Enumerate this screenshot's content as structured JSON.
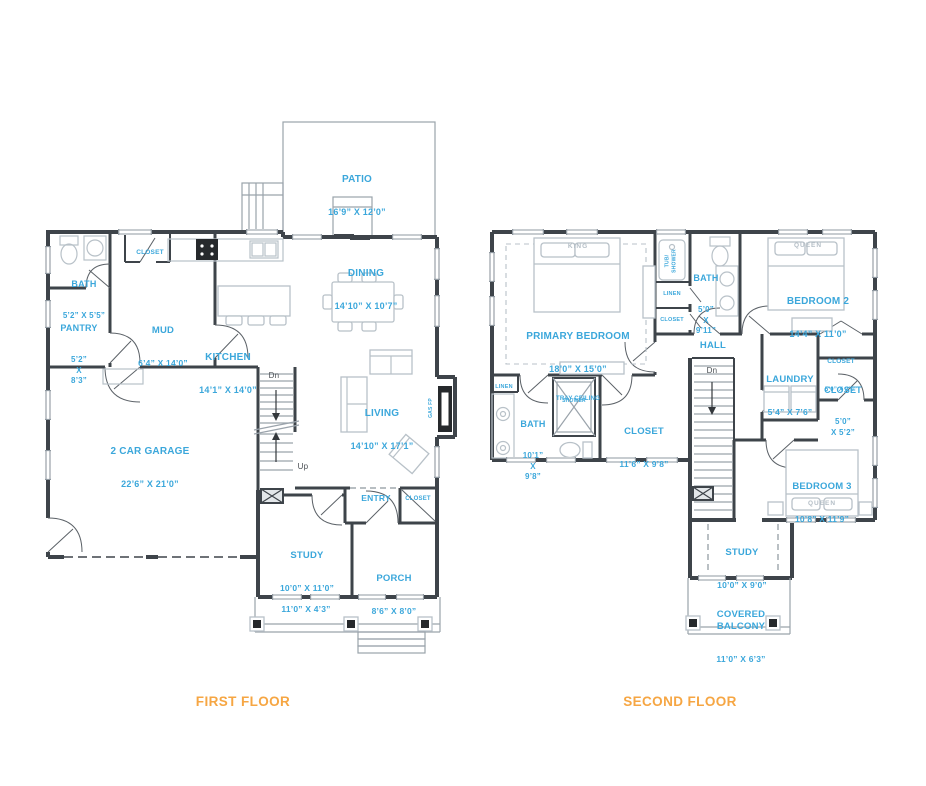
{
  "colors": {
    "blue": "#3BA7DB",
    "orange": "#F6A643",
    "wall": "#3E444A",
    "line": "#9AA3AB",
    "furn": "#B8C1C8",
    "graytext": "#B4BEC6"
  },
  "first_floor": {
    "title": "FIRST FLOOR",
    "rooms": {
      "patio": {
        "name": "PATIO",
        "dims": "16’9” X 12’0”"
      },
      "bath": {
        "name": "BATH",
        "dims": "5’2” X 5’5”"
      },
      "mud_closet": {
        "name": "CLOSET"
      },
      "pantry": {
        "name": "PANTRY",
        "dims": "5’2”\nX\n8’3”"
      },
      "mud": {
        "name": "MUD",
        "dims": "6’4” X 14’0”"
      },
      "kitchen": {
        "name": "KITCHEN",
        "dims": "14’1” X 14’0”"
      },
      "dining": {
        "name": "DINING",
        "dims": "14’10” X 10’7”"
      },
      "living": {
        "name": "LIVING",
        "dims": "14’10” X 17’1”"
      },
      "garage": {
        "name": "2 CAR GARAGE",
        "dims": "22’6” X 21’0”"
      },
      "entry": {
        "name": "ENTRY"
      },
      "entry_closet": {
        "name": "CLOSET"
      },
      "study": {
        "name": "STUDY",
        "dims": "10’0” X 11’0”"
      },
      "porch": {
        "name": "PORCH",
        "dims": "8’6” X 8’0”"
      },
      "front_porch_dims": "11’0” X 4’3”",
      "gas_fireplace": "GAS FP",
      "stairs_dn": "Dn",
      "stairs_up": "Up"
    }
  },
  "second_floor": {
    "title": "SECOND FLOOR",
    "rooms": {
      "primary": {
        "name": "PRIMARY BEDROOM",
        "dims": "18’0” X 15’0”",
        "note": "TRAY CEILING",
        "bed": "KING"
      },
      "tub_shower": "TUB/\nSHOWER",
      "bath_small": {
        "name": "BATH",
        "dims": "5’0”\nX\n9’11”"
      },
      "linen_hall": "LINEN",
      "closet_hall": "CLOSET",
      "bedroom2": {
        "name": "BEDROOM 2",
        "dims": "14’4” X 11’0”",
        "bed": "QUEEN"
      },
      "hall": {
        "name": "HALL"
      },
      "stairs_dn": "Dn",
      "laundry": {
        "name": "LAUNDRY",
        "dims": "5’4” X 7’6”"
      },
      "closet_small": {
        "name": "CLOSET",
        "dims": "5’0” X 2’0”"
      },
      "closet_bed2": {
        "name": "CLOSET",
        "dims": "5’0”\nX 5’2”"
      },
      "linen_bath": "LINEN",
      "bath_primary": {
        "name": "BATH",
        "dims": "10’1”\nX\n9’8”"
      },
      "shower": "SHOWER",
      "closet_primary": {
        "name": "CLOSET",
        "dims": "11’6” X 9’8”"
      },
      "bedroom3": {
        "name": "BEDROOM 3",
        "dims": "10’8” X 11’9”",
        "bed": "QUEEN"
      },
      "study": {
        "name": "STUDY",
        "dims": "10’0” X 9’0”"
      },
      "balcony": {
        "name": "COVERED\nBALCONY",
        "dims": "11’0” X 6’3”"
      }
    }
  }
}
